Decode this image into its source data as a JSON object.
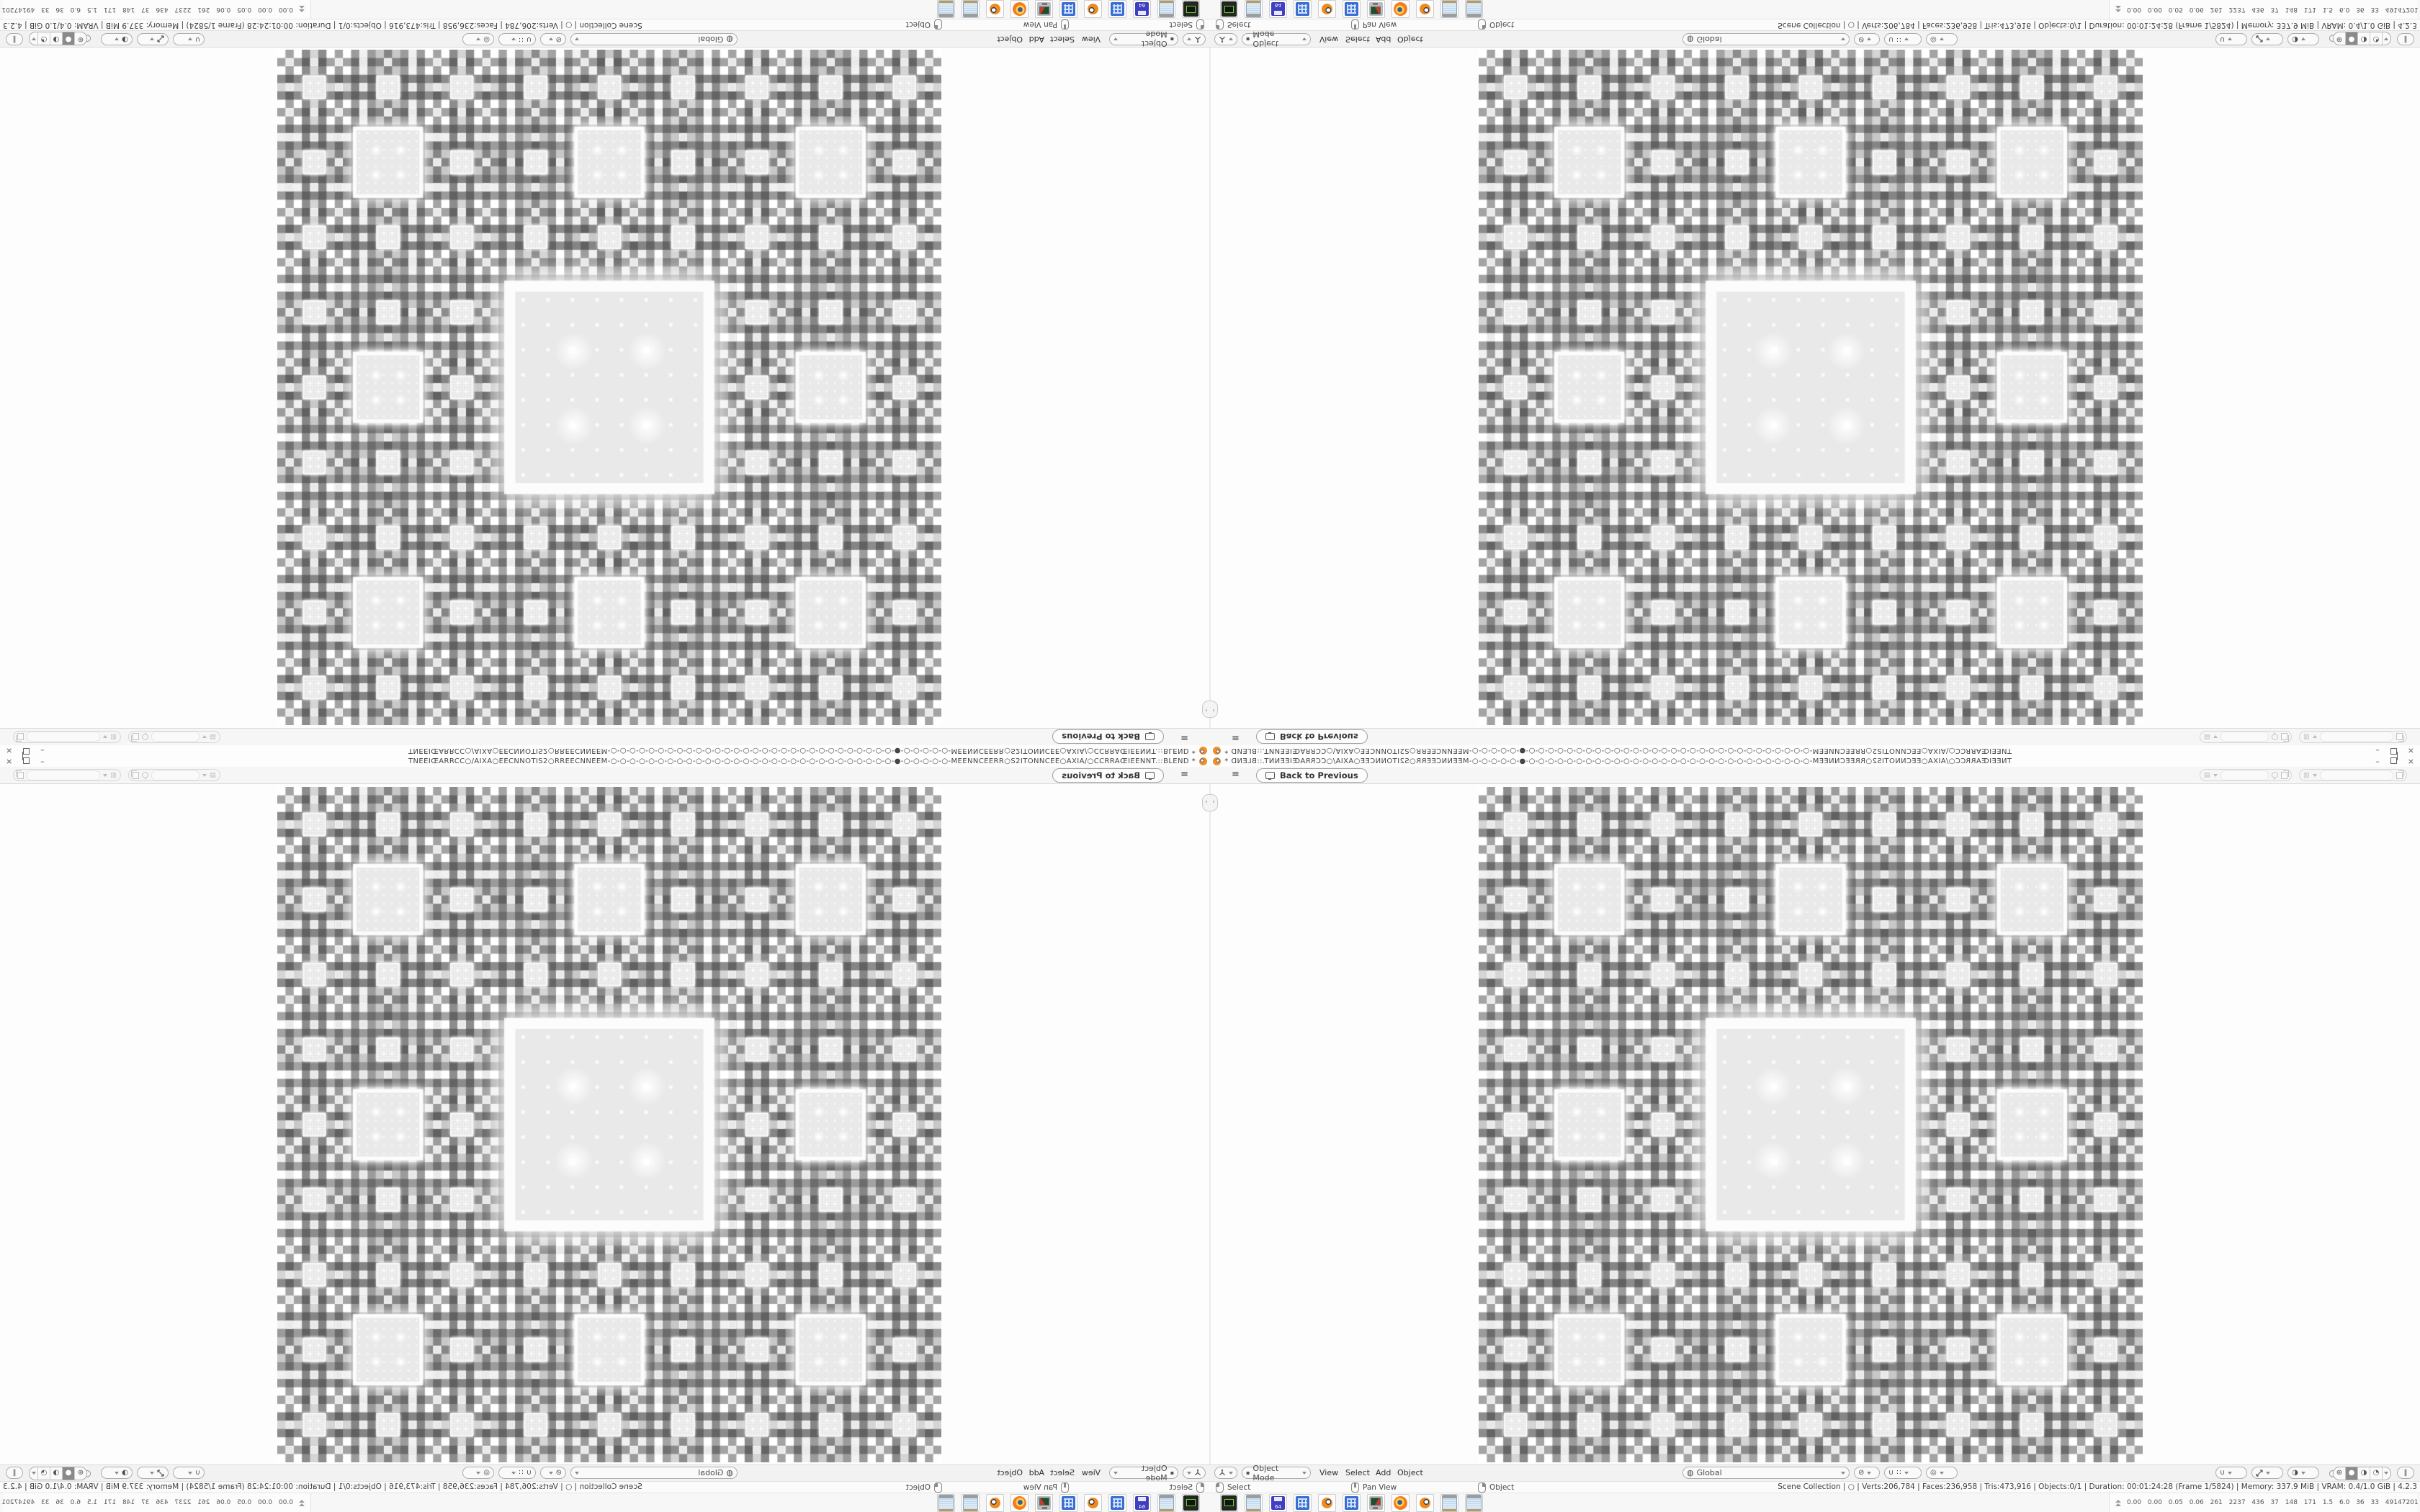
{
  "window": {
    "title": "TNEEIŒARRCC○/AIXA○EECNNOTIS2○RREECNNEEM-○-○-○-○-○-○-○-○-○-○-○-○-○-○-○-○-○-○-○-○-○-○-○-○-○-○-○-○-○-○-●-○-○-○-○-○-MEENNCEERR○S2ITONNCEE○AXIA/○CCRRAŒIEENNT.::BLEND *"
  },
  "icons": {
    "hamburger": "≡",
    "minimize": "–",
    "close": "×",
    "handle": "‹",
    "scene": "▤",
    "viewlayer": "▥",
    "mode": "▪",
    "orientation": "◍",
    "pivot": "⊘",
    "snap_detail": "∷",
    "magnet": "∪",
    "proportional": "◎",
    "sphere": "◑",
    "circle": "○",
    "wireframe": "⊕",
    "solid": "●",
    "material": "◑",
    "rendered": "◔",
    "xray": "‖"
  },
  "topbar": {
    "back_label": "Back to Previous"
  },
  "viewport": {
    "fractal": {
      "type": "sierpinski_carpet",
      "levels": 4,
      "grid": 81,
      "light": 0.97,
      "dark": 0.52,
      "coarse": 0.78,
      "base": 55,
      "scale": 215,
      "hole_fill": "#e9e9e9",
      "glow": "#ffffff"
    }
  },
  "header": {
    "mode_label": "Object Mode",
    "menus": [
      "View",
      "Select",
      "Add",
      "Object"
    ],
    "orientation_label": "Global"
  },
  "statusbar": {
    "hints": [
      {
        "button": "left-mouse",
        "label": "Select"
      },
      {
        "button": "middle-mouse",
        "label": "Pan View"
      },
      {
        "button": "right-mouse",
        "label": "Object"
      }
    ],
    "stats_text": "Scene Collection | ○ | Verts:206,784 | Faces:236,958 | Tris:473,916 | Objects:0/1 | Duration: 00:01:24:28 (Frame 1/5824) | Memory: 337.9 MiB | VRAM: 0.4/1.0 GiB | 4.2.3"
  },
  "taskbar": {
    "disk_label": "64",
    "apps": [
      "capture-tool",
      "notepad",
      "disk-64",
      "calculator",
      "blender",
      "calculator",
      "display-settings",
      "firefox",
      "blender",
      "notepad",
      "notepad"
    ],
    "perf": {
      "numbers": "0.00 0.00 0.05 0.06 261 2237 436 37 148 171 1.5 6.0 36 33 49147201",
      "bars": [
        {
          "color": "#e3dd55",
          "w": 16,
          "h": 3
        },
        {
          "color": "#e3dd55",
          "w": 12,
          "h": 3
        },
        {
          "color": "#8a4a1b",
          "w": 12,
          "h": 10
        },
        {
          "color": "#1d4e9e",
          "w": 11,
          "h": 17
        },
        {
          "color": "#8a4a1b",
          "w": 10,
          "h": 8
        },
        {
          "color": "#49a94c",
          "w": 9,
          "h": 3
        },
        {
          "color": "#c43b2d",
          "w": 5,
          "h": 3
        },
        {
          "color": "#49a94c",
          "w": 5,
          "h": 6
        }
      ]
    }
  }
}
